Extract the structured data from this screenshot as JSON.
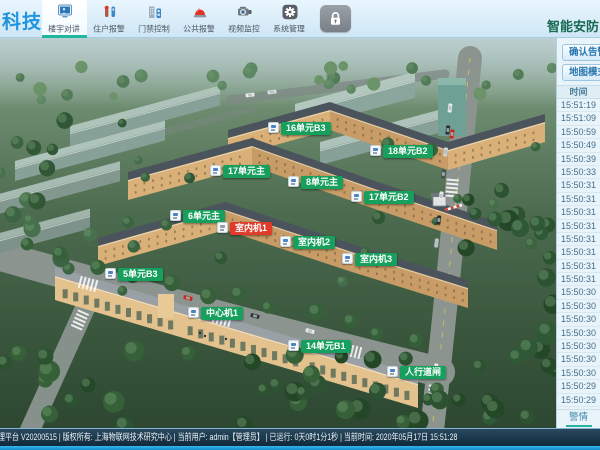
{
  "topbar": {
    "logo_text": "科技",
    "app_title": "智能安防",
    "items": [
      {
        "label": "楼宇对讲",
        "active": true
      },
      {
        "label": "住户报警",
        "active": false
      },
      {
        "label": "门禁控制",
        "active": false
      },
      {
        "label": "公共报警",
        "active": false
      },
      {
        "label": "视频监控",
        "active": false
      },
      {
        "label": "系统管理",
        "active": false
      }
    ]
  },
  "sidebar": {
    "confirm_button": "确认告警",
    "mode_button": "地图模式",
    "table_header": "时间",
    "times": [
      "15:51:19",
      "15:51:09",
      "15:50:59",
      "15:50:49",
      "15:50:39",
      "15:50:33",
      "15:50:31",
      "15:50:31",
      "15:50:31",
      "15:50:31",
      "15:50:31",
      "15:50:31",
      "15:50:31",
      "15:50:31",
      "15:50:30",
      "15:50:30",
      "15:50:30",
      "15:50:30",
      "15:50:30",
      "15:50:30",
      "15:50:30",
      "15:50:29",
      "15:50:29"
    ],
    "bottom_tab": "警情"
  },
  "map": {
    "devices": [
      {
        "label": "16单元B3",
        "x": 268,
        "y": 84,
        "state": "normal"
      },
      {
        "label": "18单元B2",
        "x": 370,
        "y": 107,
        "state": "normal"
      },
      {
        "label": "17单元主",
        "x": 210,
        "y": 127,
        "state": "normal"
      },
      {
        "label": "8单元主",
        "x": 288,
        "y": 138,
        "state": "normal"
      },
      {
        "label": "17单元B2",
        "x": 351,
        "y": 153,
        "state": "normal"
      },
      {
        "label": "6单元主",
        "x": 170,
        "y": 172,
        "state": "normal"
      },
      {
        "label": "室内机1",
        "x": 217,
        "y": 184,
        "state": "alarm"
      },
      {
        "label": "室内机2",
        "x": 280,
        "y": 198,
        "state": "normal"
      },
      {
        "label": "室内机3",
        "x": 342,
        "y": 215,
        "state": "normal"
      },
      {
        "label": "5单元B3",
        "x": 105,
        "y": 230,
        "state": "normal"
      },
      {
        "label": "中心机1",
        "x": 188,
        "y": 269,
        "state": "normal"
      },
      {
        "label": "14单元B1",
        "x": 288,
        "y": 302,
        "state": "normal"
      },
      {
        "label": "人行道闸",
        "x": 387,
        "y": 328,
        "state": "normal"
      }
    ]
  },
  "statusbar": {
    "text": "理平台 V20200515 | 版权所有: 上海物联网技术研究中心 | 当前用户: admin【管理员】 | 已运行: 0天0时1分1秒 | 当前时间: 2020年05月17日 15:51:28"
  },
  "colors": {
    "accent_teal": "#23b3a0",
    "tag_green": "#17a05d",
    "tag_alarm_red": "#e03a2b",
    "logo_blue": "#1d95df",
    "title_green": "#176a50"
  }
}
